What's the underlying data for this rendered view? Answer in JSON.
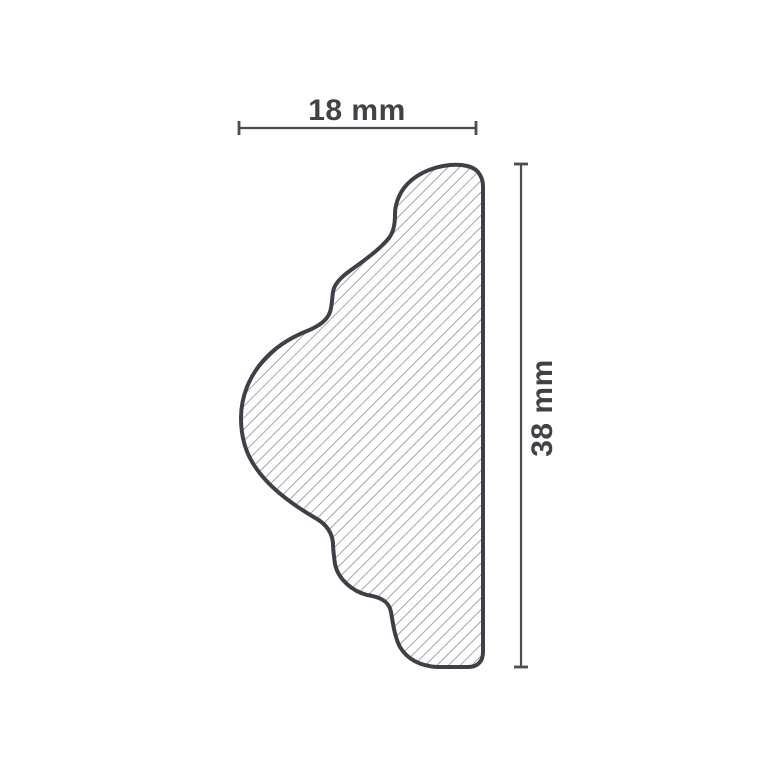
{
  "diagram": {
    "width_label": "18 mm",
    "height_label": "38 mm",
    "width_mm": 18,
    "height_mm": 38,
    "colors": {
      "background": "#ffffff",
      "outline": "#3d4147",
      "hatch": "#85888c",
      "dimension_line": "#4a4e53",
      "label_text": "#3f4347"
    }
  }
}
